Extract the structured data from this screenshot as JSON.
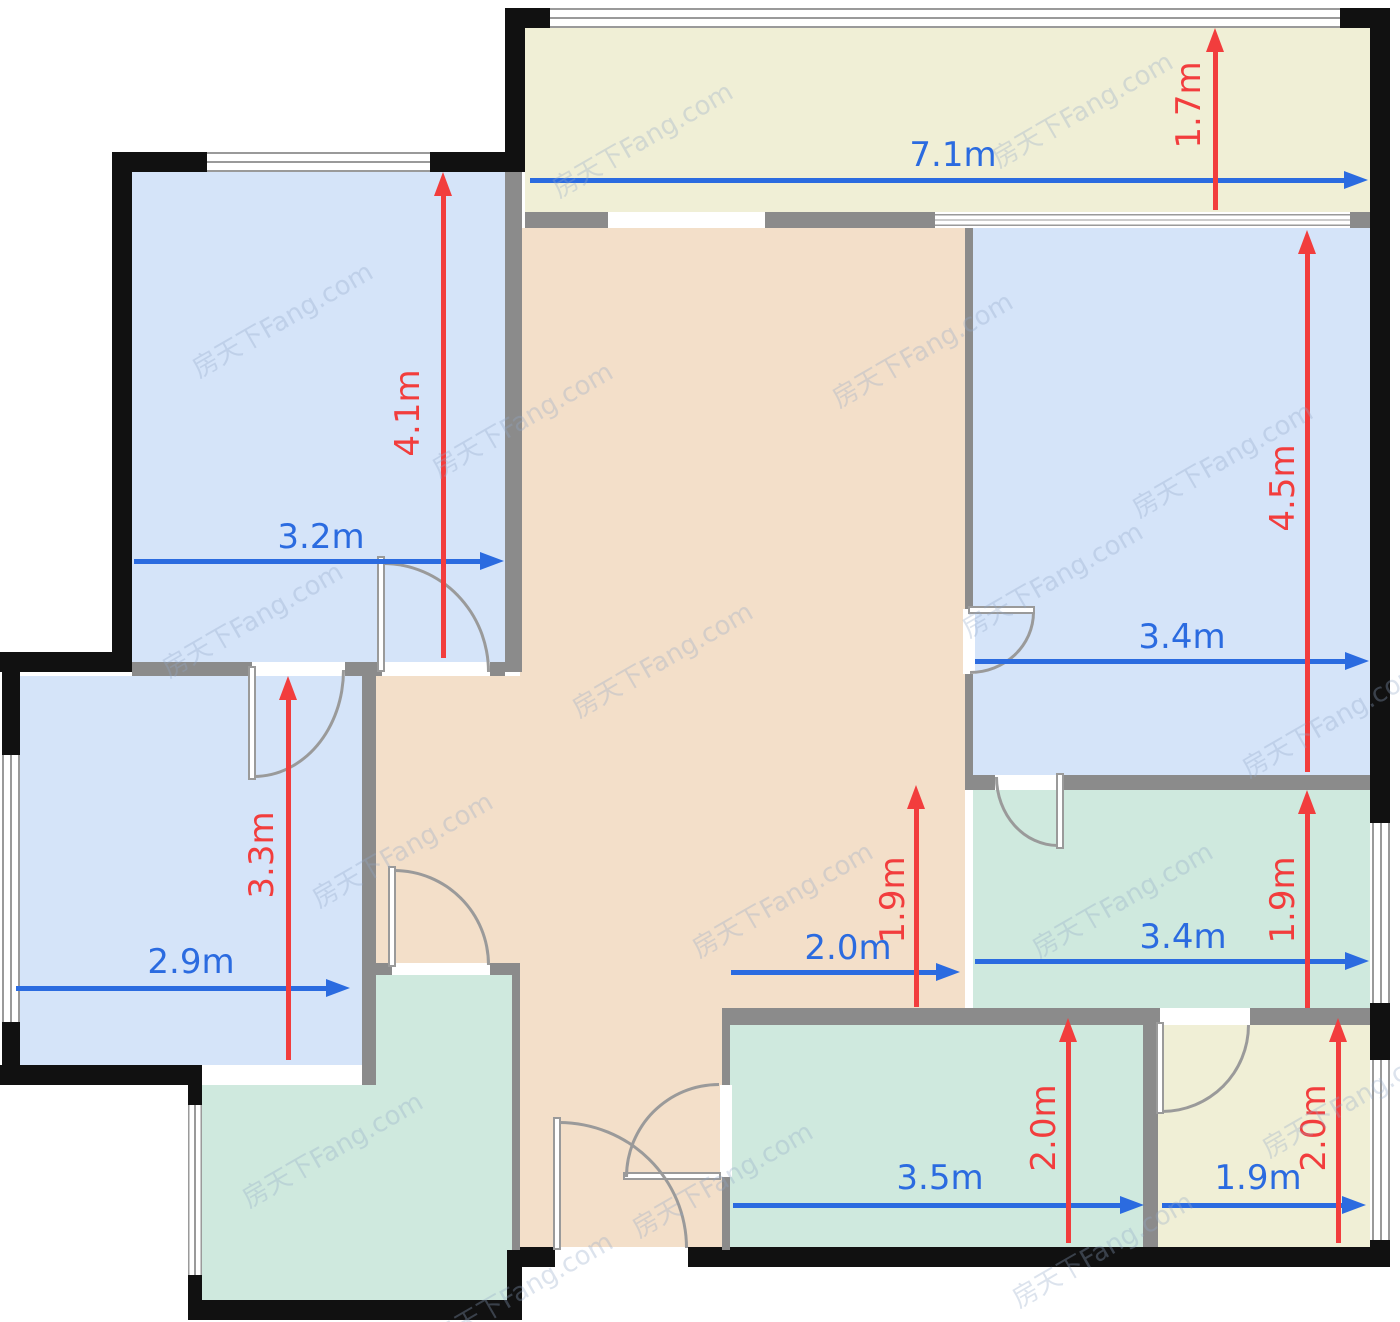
{
  "watermark": {
    "text": "房天下Fang.com"
  },
  "colors": {
    "bedroom_fill": "#d5e4f9",
    "living_hall_fill": "#f3dfc9",
    "wet_room_fill": "#cfe9de",
    "balcony_fill": "#f0efd6",
    "exterior_wall": "#111111",
    "interior_wall": "#8b8b8b",
    "window_line": "#9a9a9a",
    "dimension_blue": "#2b6be0",
    "dimension_red": "#f23d3d"
  },
  "dims": {
    "bed_top_left_width": {
      "label": "3.2m"
    },
    "bed_top_left_height": {
      "label": "4.1m"
    },
    "balcony_width": {
      "label": "7.1m"
    },
    "balcony_height": {
      "label": "1.7m"
    },
    "bed_right_width": {
      "label": "3.4m"
    },
    "bed_right_height": {
      "label": "4.5m"
    },
    "bed_left_width": {
      "label": "2.9m"
    },
    "bed_left_height": {
      "label": "3.3m"
    },
    "hall_width": {
      "label": "2.0m"
    },
    "hall_height": {
      "label": "1.9m"
    },
    "bath_width": {
      "label": "3.4m"
    },
    "bath_height": {
      "label": "1.9m"
    },
    "bottom_center_width": {
      "label": "3.5m"
    },
    "bottom_center_height": {
      "label": "2.0m"
    },
    "bottom_right_width": {
      "label": "1.9m"
    },
    "bottom_right_height": {
      "label": "2.0m"
    }
  },
  "rooms": [
    {
      "id": "bedroom-top-left",
      "fill": "#d5e4f9",
      "width_label": "3.2m",
      "height_label": "4.1m"
    },
    {
      "id": "balcony-top",
      "fill": "#f0efd6",
      "width_label": "7.1m",
      "height_label": "1.7m"
    },
    {
      "id": "bedroom-right",
      "fill": "#d5e4f9",
      "width_label": "3.4m",
      "height_label": "4.5m"
    },
    {
      "id": "bedroom-left",
      "fill": "#d5e4f9",
      "width_label": "2.9m",
      "height_label": "3.3m"
    },
    {
      "id": "living-hallway",
      "fill": "#f3dfc9",
      "width_label": "2.0m",
      "height_label": "1.9m"
    },
    {
      "id": "bathroom-right",
      "fill": "#cfe9de",
      "width_label": "3.4m",
      "height_label": "1.9m"
    },
    {
      "id": "kitchen-bottom-left",
      "fill": "#cfe9de"
    },
    {
      "id": "room-bottom-center",
      "fill": "#cfe9de",
      "width_label": "3.5m",
      "height_label": "2.0m"
    },
    {
      "id": "room-bottom-right",
      "fill": "#f0efd6",
      "width_label": "1.9m",
      "height_label": "2.0m"
    }
  ]
}
